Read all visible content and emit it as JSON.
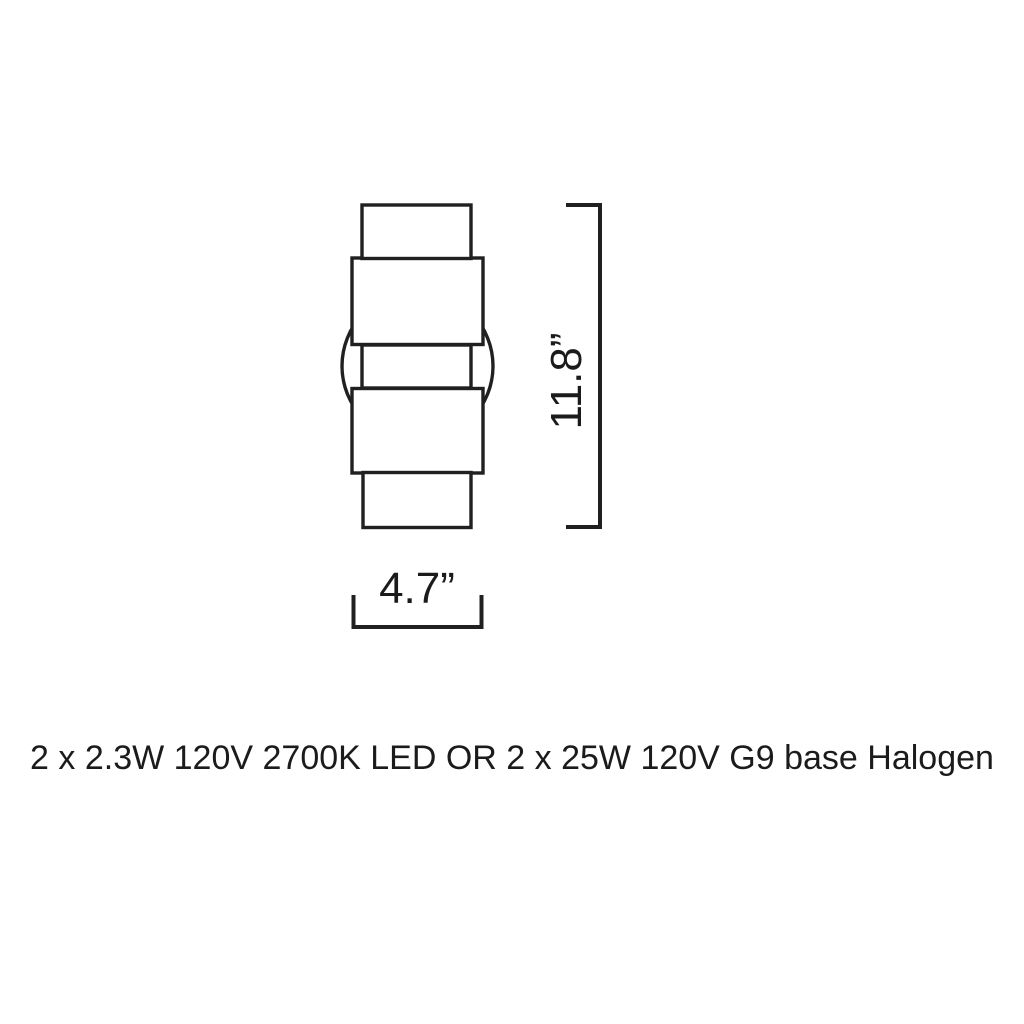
{
  "diagram": {
    "type": "product-dimension-drawing",
    "height_label": "11.8”",
    "width_label": "4.7”",
    "height_value_inches": 11.8,
    "width_value_inches": 4.7,
    "spec_text": "2 x 2.3W 120V 2700K LED OR 2 x 25W 120V G9 base Halogen"
  },
  "colors": {
    "background": "#ffffff",
    "line": "#202020",
    "text": "#1b1b1b"
  }
}
